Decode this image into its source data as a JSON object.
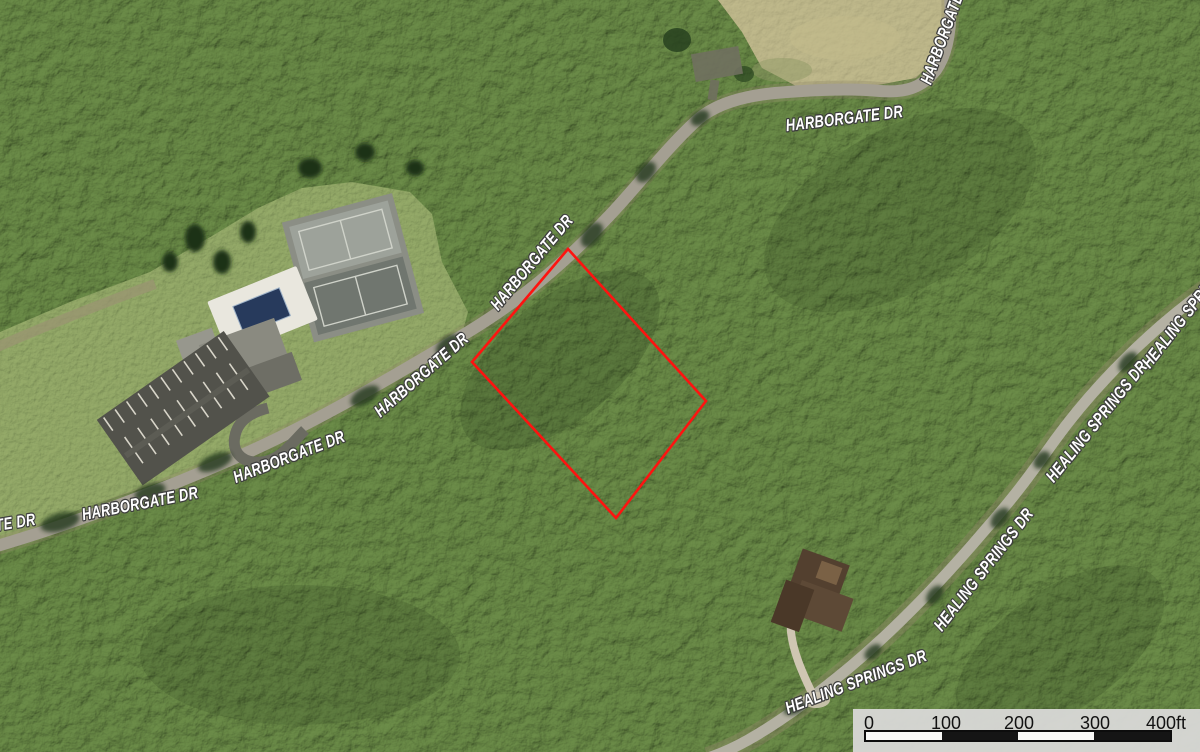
{
  "map": {
    "roads": {
      "harborgate": {
        "name": "HARBORGATE DR"
      },
      "healing_springs": {
        "name": "HEALING SPRINGS DR"
      }
    },
    "parcel": {
      "points": "568,249 706,401 616,518 472,362",
      "color": "#fe1310"
    },
    "scale_bar": {
      "ticks": [
        "0",
        "100",
        "200",
        "300"
      ],
      "end_label": "400ft"
    }
  }
}
